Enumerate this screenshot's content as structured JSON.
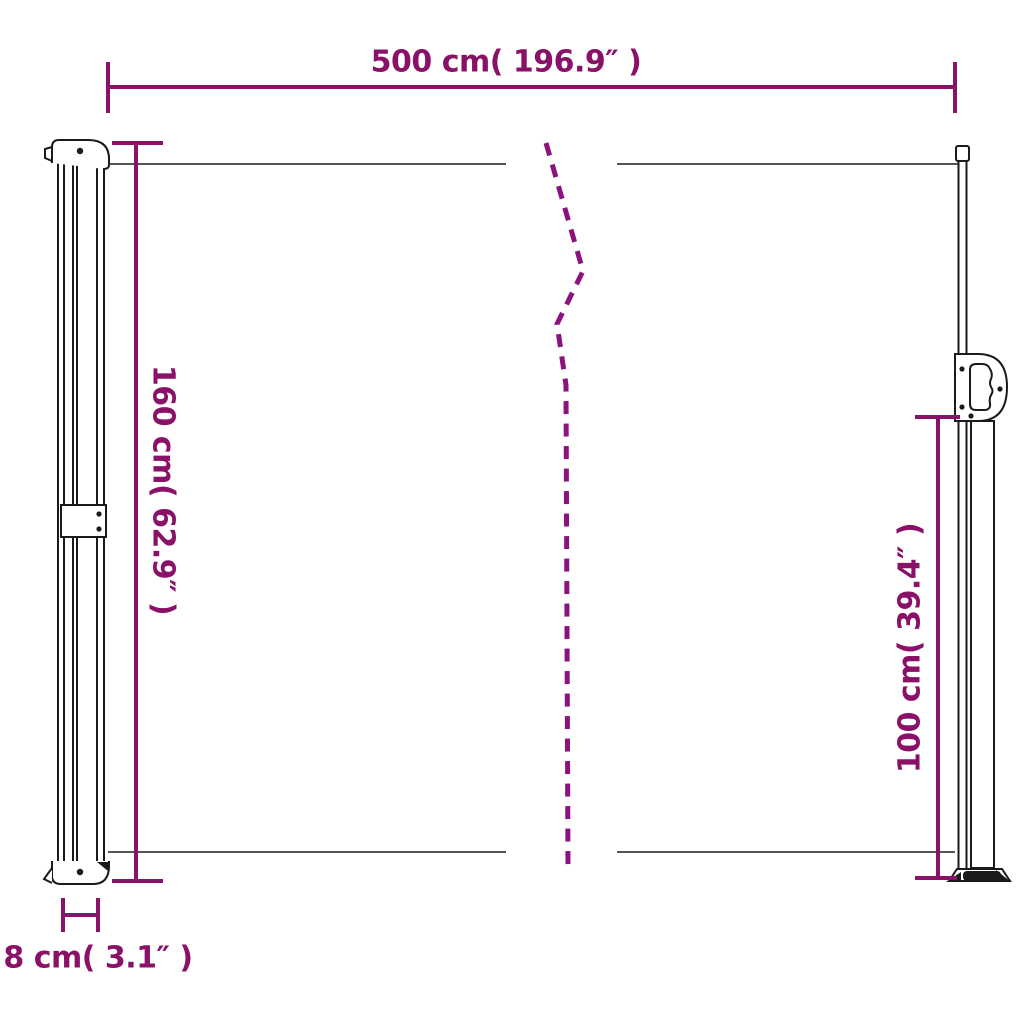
{
  "colors": {
    "accent": "#8A1168",
    "dash": "#8B1380",
    "outline": "#1a1a1a",
    "fabric_line": "#555555",
    "background": "#FFFFFF"
  },
  "diagram": {
    "dimensions": {
      "width": {
        "label": "500 cm( 196.9″ )",
        "cm": 500,
        "inch": 196.9
      },
      "left_height": {
        "label": "160 cm( 62.9″ )",
        "cm": 160,
        "inch": 62.9
      },
      "right_height": {
        "label": "100 cm( 39.4″ )",
        "cm": 100,
        "inch": 39.4
      },
      "cassette_depth": {
        "label": "8 cm( 3.1″ )",
        "cm": 8,
        "inch": 3.1
      }
    }
  }
}
